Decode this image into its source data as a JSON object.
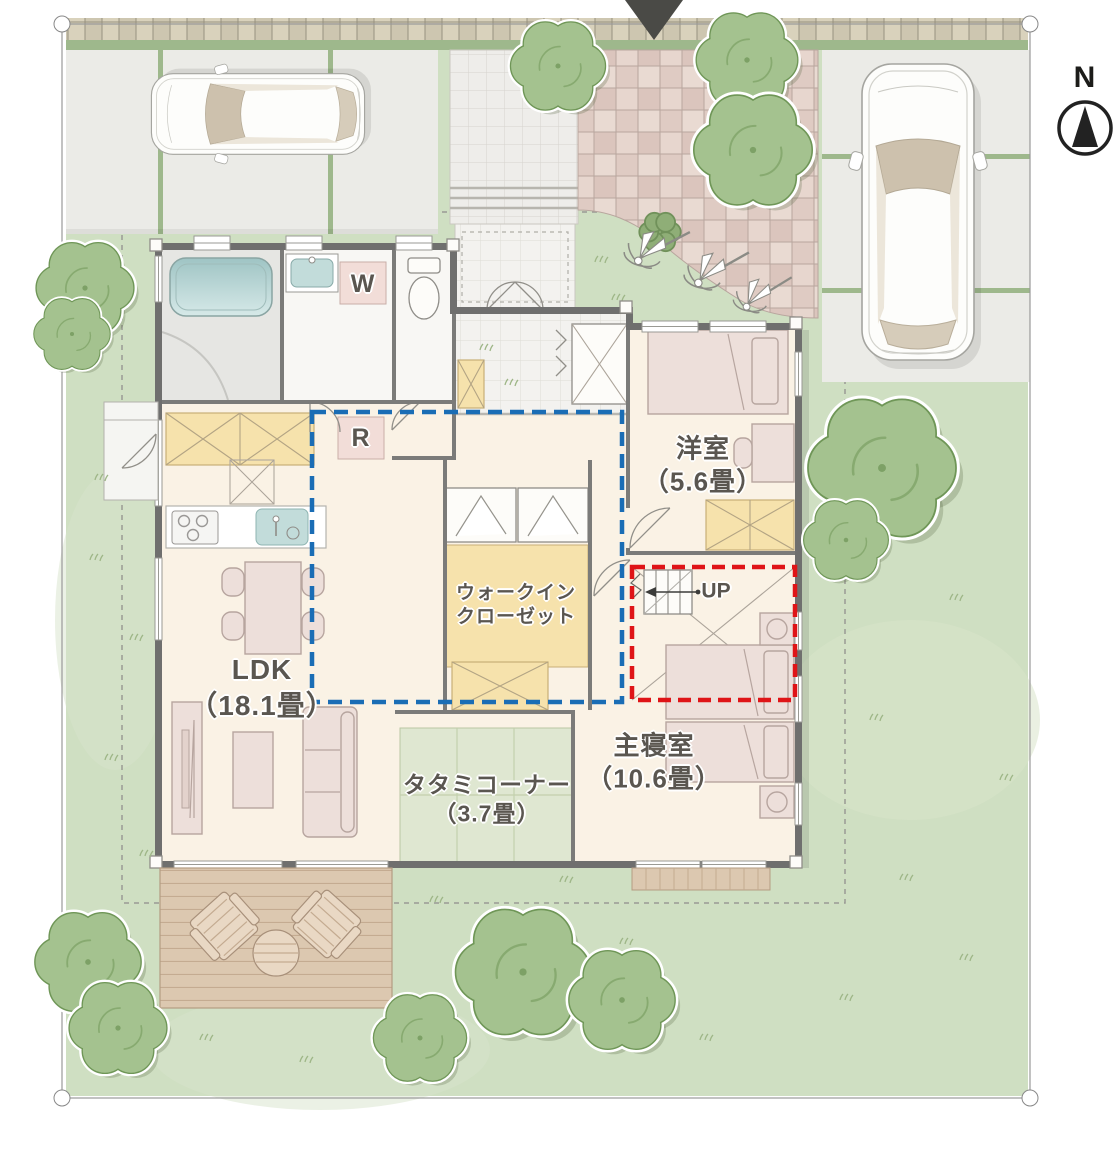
{
  "compass": {
    "north_label": "N"
  },
  "rooms": {
    "western_room": {
      "name": "洋室",
      "size": "（5.6畳）"
    },
    "ldk": {
      "name": "LDK",
      "size": "（18.1畳）"
    },
    "walk_in_closet": {
      "line1": "ウォークイン",
      "line2": "クローゼット"
    },
    "tatami_corner": {
      "name": "タタミコーナー",
      "size": "（3.7畳）"
    },
    "master_bedroom": {
      "name": "主寝室",
      "size": "（10.6畳）"
    }
  },
  "appliances": {
    "washing_machine": "W",
    "refrigerator": "R"
  },
  "stairs": {
    "up_label": "UP"
  },
  "colors": {
    "lawn": "#cfdfc2",
    "tree": "#a4c28f",
    "tree_outline": "#6f9657",
    "floor": "#faf2e5",
    "wall": "#6f6f6e",
    "tatami": "#dfe7d1",
    "closet_yellow": "#f6e2ac",
    "furniture": "#eddfda",
    "furniture_outline": "#b7a59f",
    "zone_blue": "#1a6db5",
    "zone_red": "#df1417",
    "deck": "#dcc8b0",
    "paving": "#e6d5cd",
    "parking": "#ebebe7",
    "water": "#c2dcda",
    "label_text": "#5a5650"
  }
}
